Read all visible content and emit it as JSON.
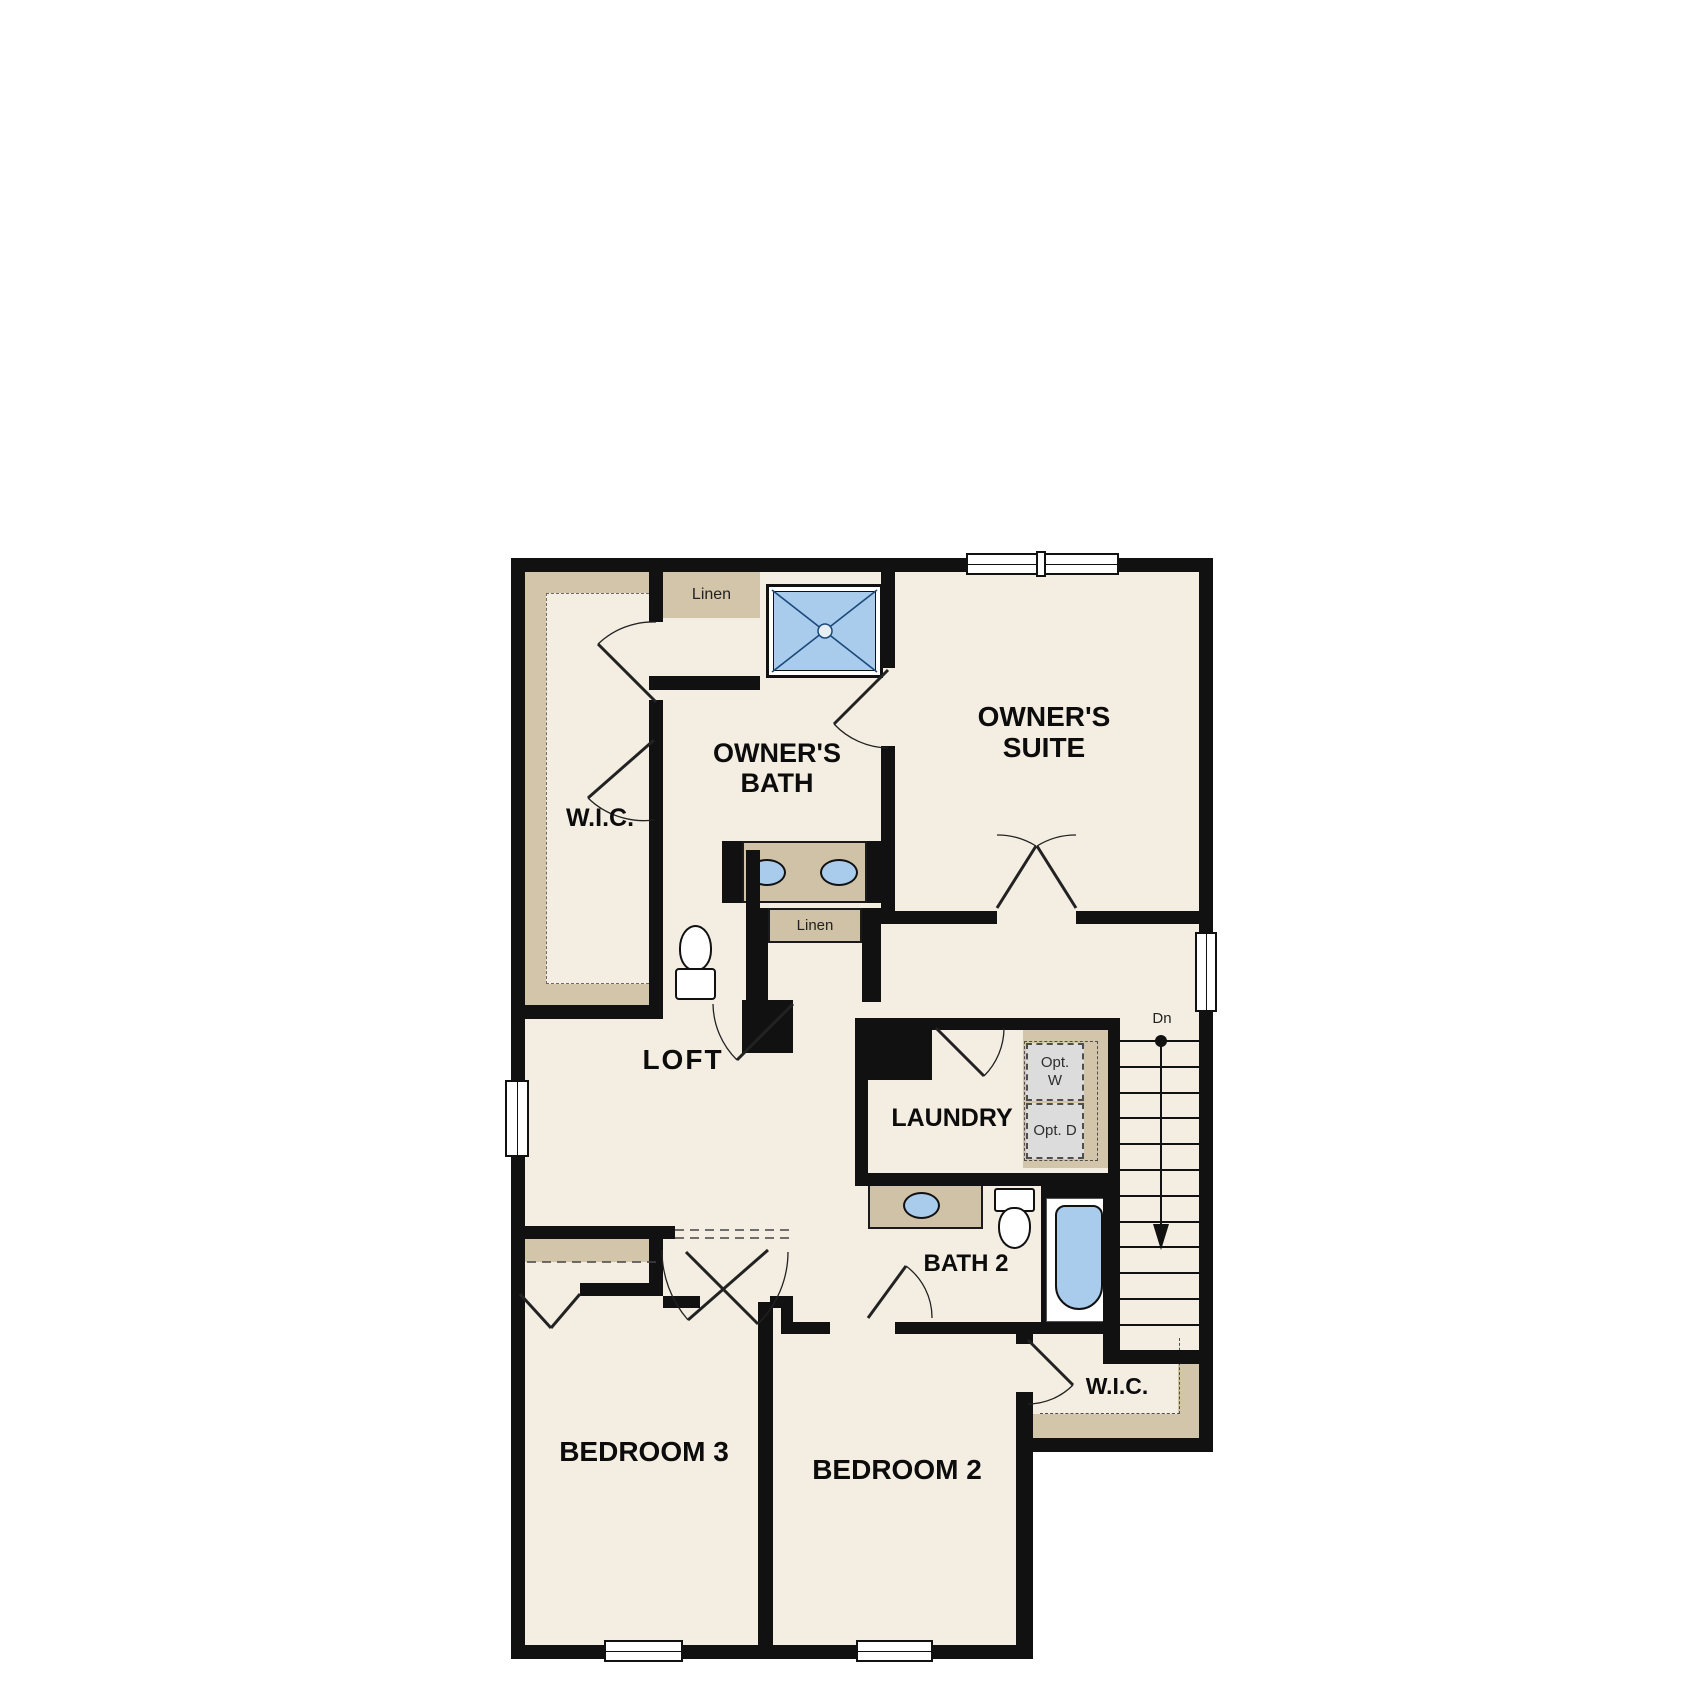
{
  "title": "Second Floor Plan",
  "colors": {
    "floor": "#f4eee2",
    "wall": "#111111",
    "shelf": "#d2c5aa",
    "counter": "#cfc2a6",
    "blue": "#a9cbec",
    "gray-wd": "#dcdcdc",
    "bg": "#ffffff"
  },
  "labels": {
    "linen_top": "Linen",
    "owners_bath": "OWNER'S BATH",
    "owners_suite": "OWNER'S SUITE",
    "wic_top": "W.I.C.",
    "linen_mid": "Linen",
    "loft": "LOFT",
    "laundry": "LAUNDRY",
    "opt_w": "Opt. W",
    "opt_d": "Opt. D",
    "dn": "Dn",
    "bath2": "BATH 2",
    "wic_bottom": "W.I.C.",
    "bedroom3": "BEDROOM 3",
    "bedroom2": "BEDROOM 2"
  },
  "stairs": {
    "tread_count": 13,
    "tread_spacing_px": 25.8,
    "direction_label": "Dn"
  }
}
